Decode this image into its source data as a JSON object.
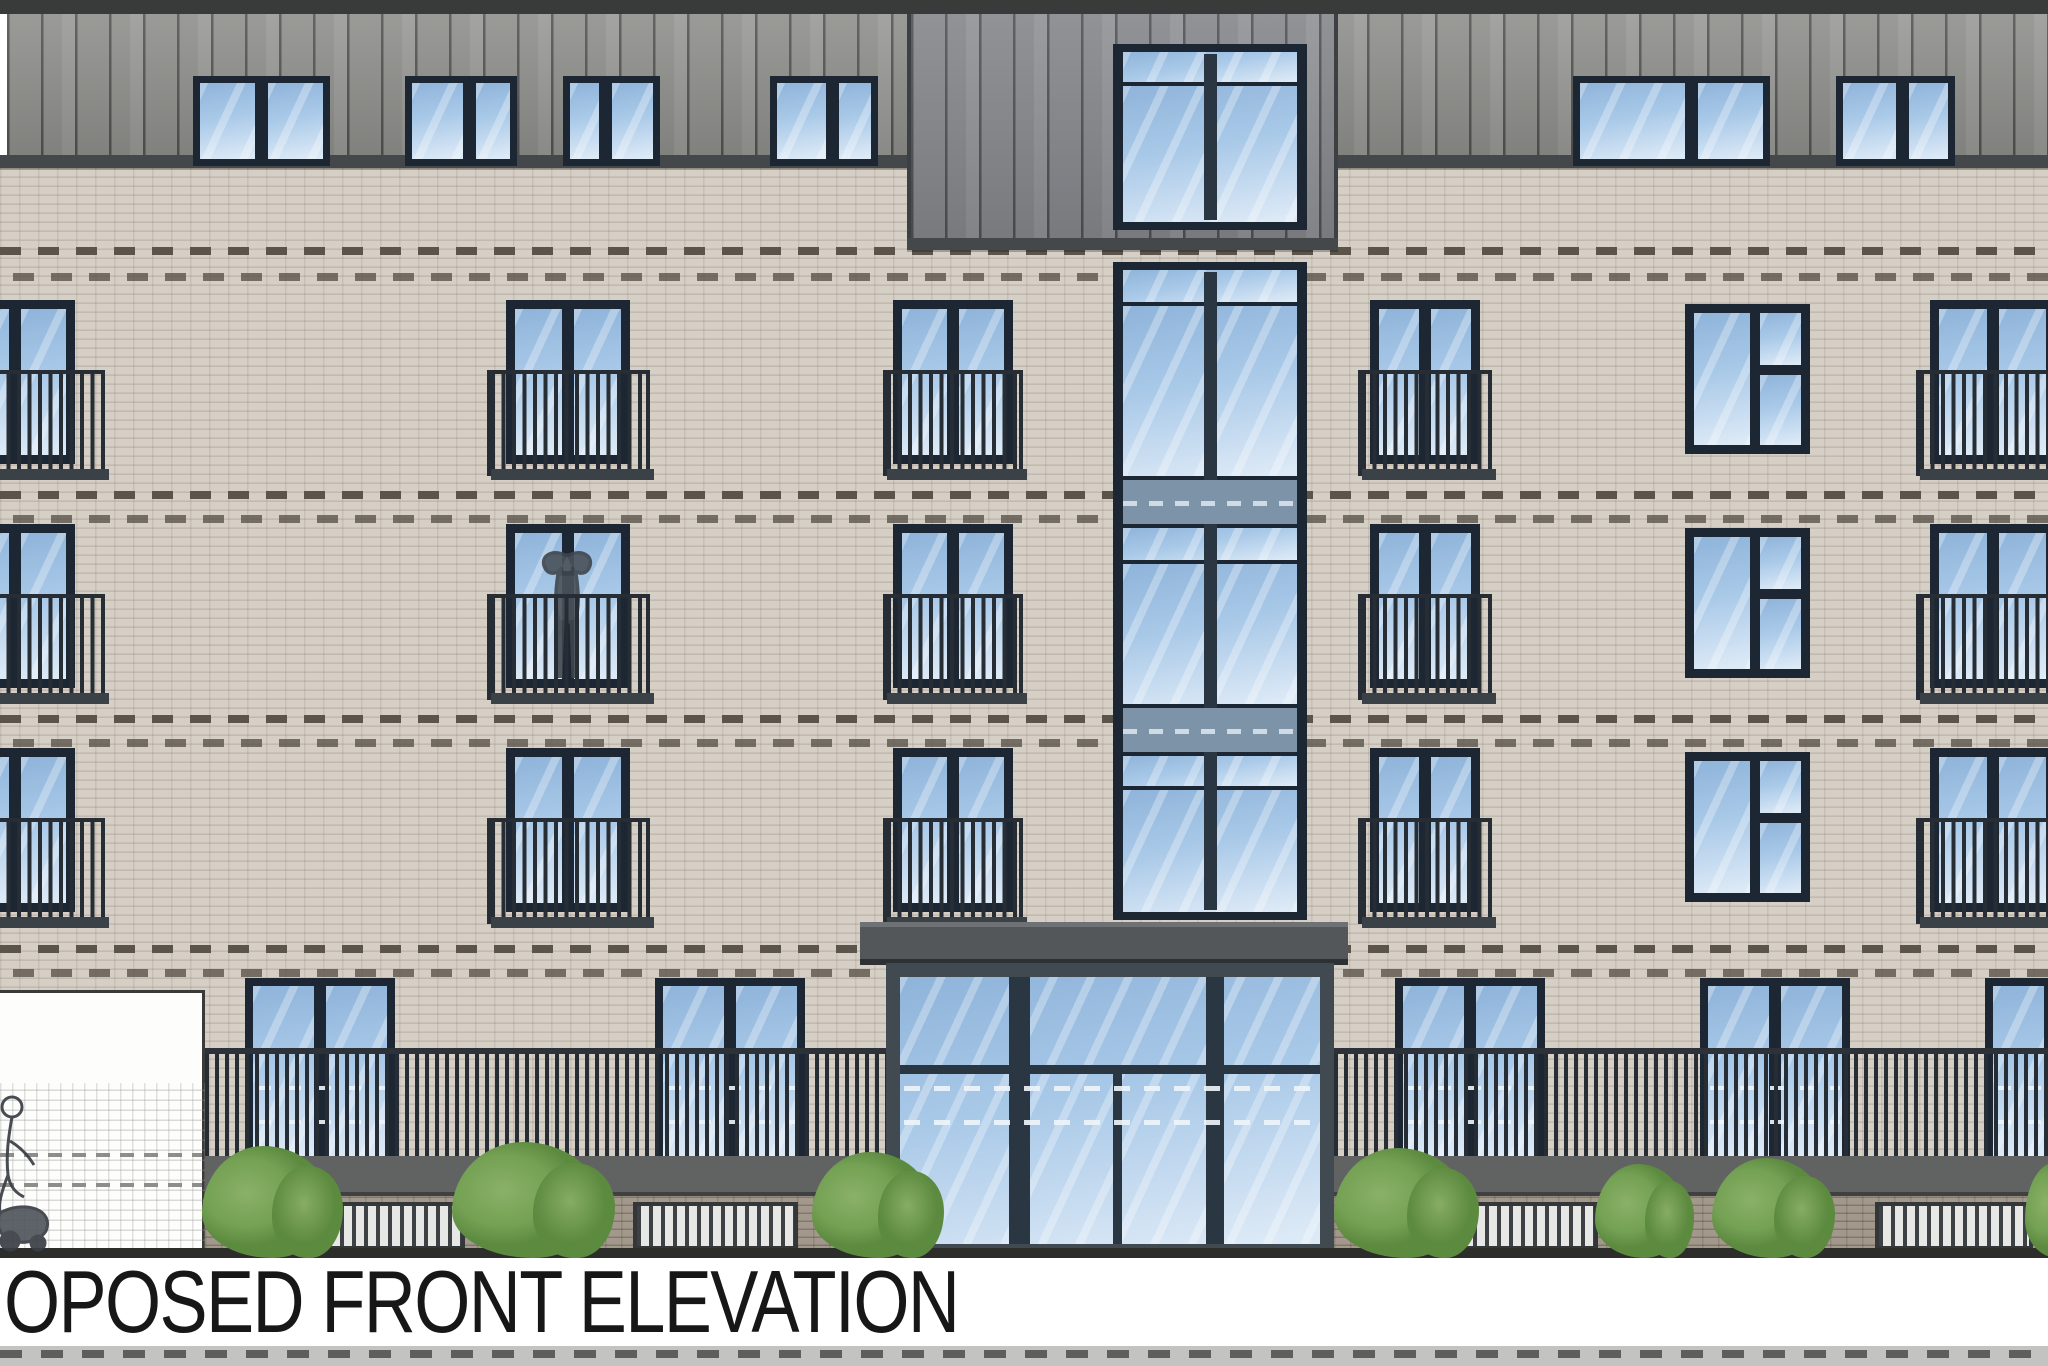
{
  "title": {
    "label": "OPOSED FRONT ELEVATION"
  },
  "palette": {
    "brick": "#d6cfc5",
    "cladding": "#8f908c",
    "towerClad": "#84868b",
    "frame": "#1c2733",
    "glassLight": "#dce9f6",
    "glassMid": "#a9c9e8",
    "glassDeep": "#8fb4da",
    "railing": "#262d34",
    "canopy": "#54575a",
    "entFrame": "#414a50",
    "bush": "#74a154",
    "bushDark": "#5c8a3f",
    "plinth": "#a2988b",
    "band": "#5a544b",
    "trim": "#45484a",
    "roof": "#393b3a",
    "fenceBg": "#e7e8e5",
    "groundLine": "#2d2d2b",
    "title": "#171717"
  },
  "drawing": {
    "roof": {
      "x": 0,
      "y": 0,
      "w": 2048,
      "h": 14
    },
    "cladding_band": {
      "x": 7,
      "y": 14,
      "w": 2041,
      "h": 141
    },
    "margin_sliver": {
      "x": 0,
      "y": 0,
      "w": 7,
      "h": 168
    },
    "trims": [
      {
        "x": 0,
        "y": 155,
        "w": 907,
        "h": 13
      },
      {
        "x": 1338,
        "y": 155,
        "w": 710,
        "h": 13
      },
      {
        "x": 907,
        "y": 238,
        "w": 431,
        "h": 12
      }
    ],
    "tower": {
      "x": 907,
      "y": 14,
      "w": 431,
      "h": 236
    },
    "brick_field": {
      "x": 0,
      "y": 164,
      "w": 2048,
      "h": 1094
    },
    "accent_bands": [
      247,
      273,
      491,
      515,
      715,
      739,
      945,
      969
    ],
    "top_windows": {
      "y": 76,
      "h": 90,
      "frame": 7,
      "mullion": 13,
      "items": [
        {
          "x": 193,
          "w": 137,
          "split": 0.5
        },
        {
          "x": 405,
          "w": 112,
          "split": 0.6
        },
        {
          "x": 563,
          "w": 97,
          "split": 0.42
        },
        {
          "x": 770,
          "w": 108,
          "split": 0.6
        },
        {
          "x": 1573,
          "w": 197,
          "split": 0.62
        },
        {
          "x": 1836,
          "w": 119,
          "split": 0.58
        }
      ]
    },
    "floors": [
      300,
      524,
      748
    ],
    "wing_window": {
      "h": 164,
      "frame": 9,
      "mullion": 12,
      "rail_dy": 70,
      "rail_h": 106
    },
    "juliet_columns": [
      {
        "x": -45,
        "w": 120,
        "rx": -50,
        "rw": 155
      },
      {
        "x": 506,
        "w": 124,
        "rx": 487,
        "rw": 163
      },
      {
        "x": 893,
        "w": 120,
        "rx": 883,
        "rw": 140
      },
      {
        "x": 1370,
        "w": 110,
        "rx": 1358,
        "rw": 134
      },
      {
        "x": 1930,
        "w": 125,
        "rx": 1916,
        "rw": 152
      }
    ],
    "stair_column": {
      "x": 1685,
      "w": 125,
      "dy": 4,
      "h": 150,
      "frame": 9
    },
    "glazed_strip": {
      "x": 1113,
      "w": 194,
      "frame": 10,
      "mullion": 13,
      "upper": {
        "y": 44,
        "h": 186,
        "rows": [
          {
            "t": "pane",
            "y": 8,
            "h": 30
          },
          {
            "t": "pane",
            "y": 42,
            "h": 136
          }
        ]
      },
      "lower": {
        "y": 262,
        "h": 658,
        "rows": [
          {
            "t": "pane",
            "y": 8,
            "h": 32
          },
          {
            "t": "pane",
            "y": 44,
            "h": 170
          },
          {
            "t": "spandrel",
            "y": 218,
            "h": 44
          },
          {
            "t": "pane",
            "y": 266,
            "h": 32
          },
          {
            "t": "pane",
            "y": 302,
            "h": 140
          },
          {
            "t": "spandrel",
            "y": 446,
            "h": 44
          },
          {
            "t": "pane",
            "y": 494,
            "h": 30
          },
          {
            "t": "pane",
            "y": 528,
            "h": 122
          }
        ]
      }
    },
    "entrance": {
      "canopy": {
        "x": 860,
        "y": 922,
        "w": 488,
        "h": 43
      },
      "screen": {
        "x": 886,
        "y": 963,
        "w": 448,
        "h": 295
      },
      "inset": 14,
      "mullions": [
        {
          "x": 123,
          "w": 21
        },
        {
          "x": 320,
          "w": 18
        }
      ],
      "door_stile": {
        "x": 227,
        "w": 9
      },
      "transom": {
        "y": 102,
        "h": 9
      },
      "glass_dashes": [
        123,
        157
      ]
    },
    "ground_windows": {
      "y": 978,
      "h": 188,
      "frame": 8,
      "mullion": 12,
      "dashes": [
        108,
        142
      ],
      "items": [
        {
          "x": 245,
          "w": 150
        },
        {
          "x": 655,
          "w": 150
        },
        {
          "x": 1395,
          "w": 150
        },
        {
          "x": 1700,
          "w": 150
        },
        {
          "x": 1985,
          "w": 130
        }
      ]
    },
    "ground_rail": {
      "top_y": 1048,
      "top_h": 6,
      "bars_y": 1054,
      "bars_h": 102,
      "beam_y": 1156,
      "beam_h": 40,
      "segments": [
        {
          "x": 205,
          "w": 681
        },
        {
          "x": 1334,
          "w": 714
        }
      ]
    },
    "plinth": {
      "y": 1196,
      "h": 58,
      "segments": [
        {
          "x": 205,
          "w": 681
        },
        {
          "x": 1334,
          "w": 714
        }
      ]
    },
    "fences": {
      "y": 1202,
      "h": 48,
      "items": [
        {
          "x": 300,
          "w": 165
        },
        {
          "x": 633,
          "w": 165
        },
        {
          "x": 1433,
          "w": 165
        },
        {
          "x": 1875,
          "w": 158
        }
      ]
    },
    "bushes": [
      {
        "x": 202,
        "w": 128,
        "h": 112
      },
      {
        "x": 452,
        "w": 148,
        "h": 116
      },
      {
        "x": 812,
        "w": 120,
        "h": 106
      },
      {
        "x": 1334,
        "w": 132,
        "h": 110
      },
      {
        "x": 1595,
        "w": 90,
        "h": 94
      },
      {
        "x": 1712,
        "w": 112,
        "h": 100
      },
      {
        "x": 2025,
        "w": 60,
        "h": 95
      }
    ],
    "white_panel": {
      "x": 0,
      "y": 990,
      "w": 205,
      "h": 268,
      "hatch_y": 1080,
      "dashes": [
        1150,
        1180
      ]
    },
    "ground_line": {
      "x": 0,
      "y": 1248,
      "w": 2048,
      "h": 10
    },
    "title_strip": {
      "x": 0,
      "y": 1258,
      "w": 2048,
      "h": 88,
      "text_x": 4
    },
    "bottom_band": {
      "x": 0,
      "y": 1346,
      "w": 2048,
      "h": 20
    },
    "figures": {
      "balcony": {
        "x": 531,
        "y": 546,
        "w": 72,
        "h": 152
      },
      "street": {
        "x": -4,
        "y": 1095,
        "w": 60,
        "h": 160
      }
    }
  }
}
